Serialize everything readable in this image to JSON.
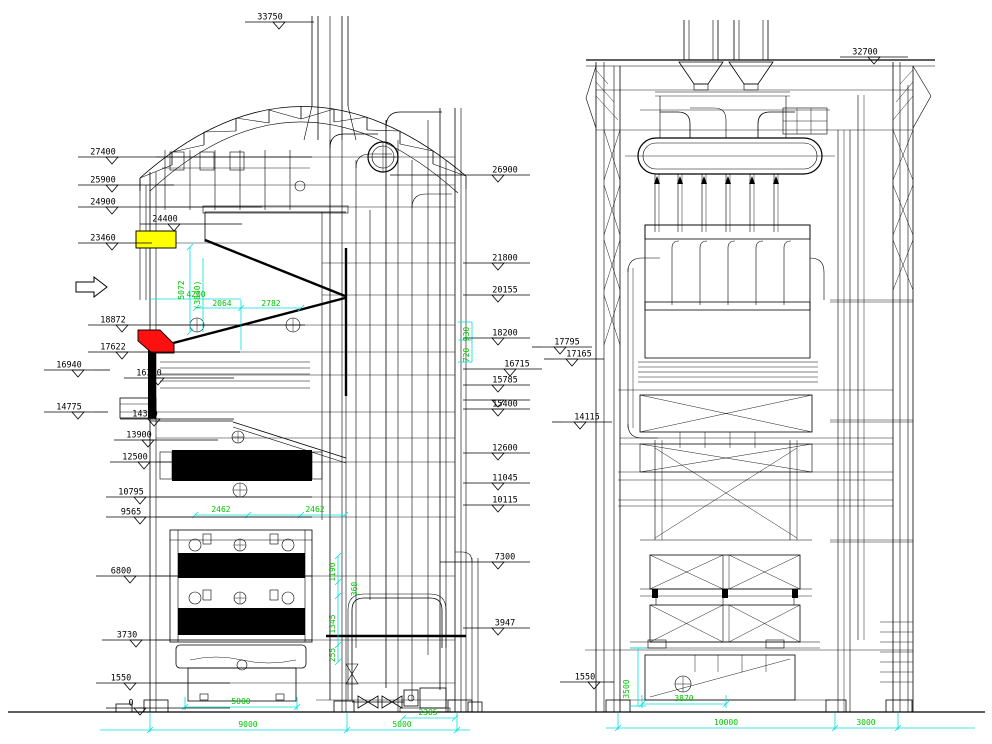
{
  "colors": {
    "background": "#ffffff",
    "line": "#000000",
    "dimension_line": "#00dfdf",
    "dimension_text": "#00c300",
    "highlight_yellow": "#ffff00",
    "highlight_red": "#ff1010"
  },
  "front_view": {
    "top_elevation": {
      "label": "33750",
      "x": 245,
      "y": 22,
      "leader": 314
    },
    "left_elevations": [
      {
        "label": "27400",
        "x": 78,
        "y": 157,
        "leader": 312
      },
      {
        "label": "25900",
        "x": 78,
        "y": 185,
        "leader": 174
      },
      {
        "label": "24900",
        "x": 78,
        "y": 207,
        "leader": 262
      },
      {
        "label": "24400",
        "x": 140,
        "y": 224,
        "leader": 242
      },
      {
        "label": "23460",
        "x": 78,
        "y": 243,
        "leader": 152
      },
      {
        "label": "18872",
        "x": 88,
        "y": 325,
        "leader": 305
      },
      {
        "label": "17622",
        "x": 88,
        "y": 352,
        "leader": 240
      },
      {
        "label": "16940",
        "x": 44,
        "y": 370,
        "leader": 110
      },
      {
        "label": "16300",
        "x": 124,
        "y": 378,
        "leader": 234
      },
      {
        "label": "14775",
        "x": 44,
        "y": 412,
        "leader": 108
      },
      {
        "label": "14300",
        "x": 120,
        "y": 419,
        "leader": 234
      },
      {
        "label": "13900",
        "x": 114,
        "y": 440,
        "leader": 218
      },
      {
        "label": "12500",
        "x": 110,
        "y": 462,
        "leader": 310
      },
      {
        "label": "10795",
        "x": 106,
        "y": 497,
        "leader": 312
      },
      {
        "label": "9565",
        "x": 106,
        "y": 517,
        "leader": 312
      },
      {
        "label": "6800",
        "x": 96,
        "y": 576,
        "leader": 312
      },
      {
        "label": "3730",
        "x": 102,
        "y": 640,
        "leader": 312
      },
      {
        "label": "1550",
        "x": 96,
        "y": 683,
        "leader": 230
      },
      {
        "label": "0",
        "x": 106,
        "y": 708,
        "leader": 230
      }
    ],
    "right_elevations": [
      {
        "label": "26900",
        "x": 480,
        "y": 175,
        "leader": 390
      },
      {
        "label": "21800",
        "x": 480,
        "y": 263,
        "leader": 463
      },
      {
        "label": "20155",
        "x": 480,
        "y": 295,
        "leader": 463
      },
      {
        "label": "18200",
        "x": 480,
        "y": 338,
        "leader": 463
      },
      {
        "label": "17795",
        "x": 542,
        "y": 347,
        "leader": 532
      },
      {
        "label": "17165",
        "x": 554,
        "y": 359,
        "leader": 544
      },
      {
        "label": "16715",
        "x": 492,
        "y": 369,
        "leader": 463
      },
      {
        "label": "15785",
        "x": 480,
        "y": 385,
        "leader": 463
      },
      {
        "label": "",
        "x": 480,
        "y": 400,
        "leader": 463
      },
      {
        "label": "15400",
        "x": 480,
        "y": 409,
        "leader": 463
      },
      {
        "label": "14115",
        "x": 562,
        "y": 422,
        "leader": 552
      },
      {
        "label": "12600",
        "x": 480,
        "y": 453,
        "leader": 463
      },
      {
        "label": "11045",
        "x": 480,
        "y": 483,
        "leader": 463
      },
      {
        "label": "10115",
        "x": 480,
        "y": 505,
        "leader": 463
      },
      {
        "label": "7300",
        "x": 480,
        "y": 562,
        "leader": 440
      },
      {
        "label": "3947",
        "x": 480,
        "y": 628,
        "leader": 463
      }
    ],
    "green_dims": [
      {
        "label": "5072",
        "x": 184,
        "y": 290,
        "rot": -90
      },
      {
        "label": "(3840)",
        "x": 200,
        "y": 295,
        "rot": -90
      },
      {
        "label": "4200",
        "x": 196,
        "y": 297,
        "rot": 0
      },
      {
        "label": "2064",
        "x": 222,
        "y": 306,
        "rot": 0
      },
      {
        "label": "2782",
        "x": 271,
        "y": 306,
        "rot": 0
      },
      {
        "label": "2462",
        "x": 221,
        "y": 512,
        "rot": 0
      },
      {
        "label": "2462",
        "x": 315,
        "y": 512,
        "rot": 0
      },
      {
        "label": "930",
        "x": 469,
        "y": 334,
        "rot": -90
      },
      {
        "label": "720",
        "x": 469,
        "y": 355,
        "rot": -90
      },
      {
        "label": "1190",
        "x": 335,
        "y": 572,
        "rot": -90
      },
      {
        "label": "360",
        "x": 357,
        "y": 589,
        "rot": -90
      },
      {
        "label": "1345",
        "x": 335,
        "y": 624,
        "rot": -90
      },
      {
        "label": "255",
        "x": 335,
        "y": 655,
        "rot": -90
      },
      {
        "label": "5000",
        "x": 241,
        "y": 704,
        "rot": 0
      },
      {
        "label": "9000",
        "x": 248,
        "y": 727,
        "rot": 0
      },
      {
        "label": "5000",
        "x": 402,
        "y": 727,
        "rot": 0
      },
      {
        "label": "2305",
        "x": 428,
        "y": 715,
        "rot": 0
      }
    ]
  },
  "side_view": {
    "top_elevation": {
      "label": "32700",
      "x": 840,
      "y": 57,
      "leader": 908
    },
    "left_elevations": [
      {
        "label": "1550",
        "x": 560,
        "y": 682,
        "leader": 614
      }
    ],
    "green_dims": [
      {
        "label": "3500",
        "x": 629,
        "y": 689,
        "rot": -90
      },
      {
        "label": "3870",
        "x": 684,
        "y": 701,
        "rot": 0
      },
      {
        "label": "10000",
        "x": 726,
        "y": 725,
        "rot": 0
      },
      {
        "label": "3000",
        "x": 866,
        "y": 725,
        "rot": 0
      }
    ]
  }
}
